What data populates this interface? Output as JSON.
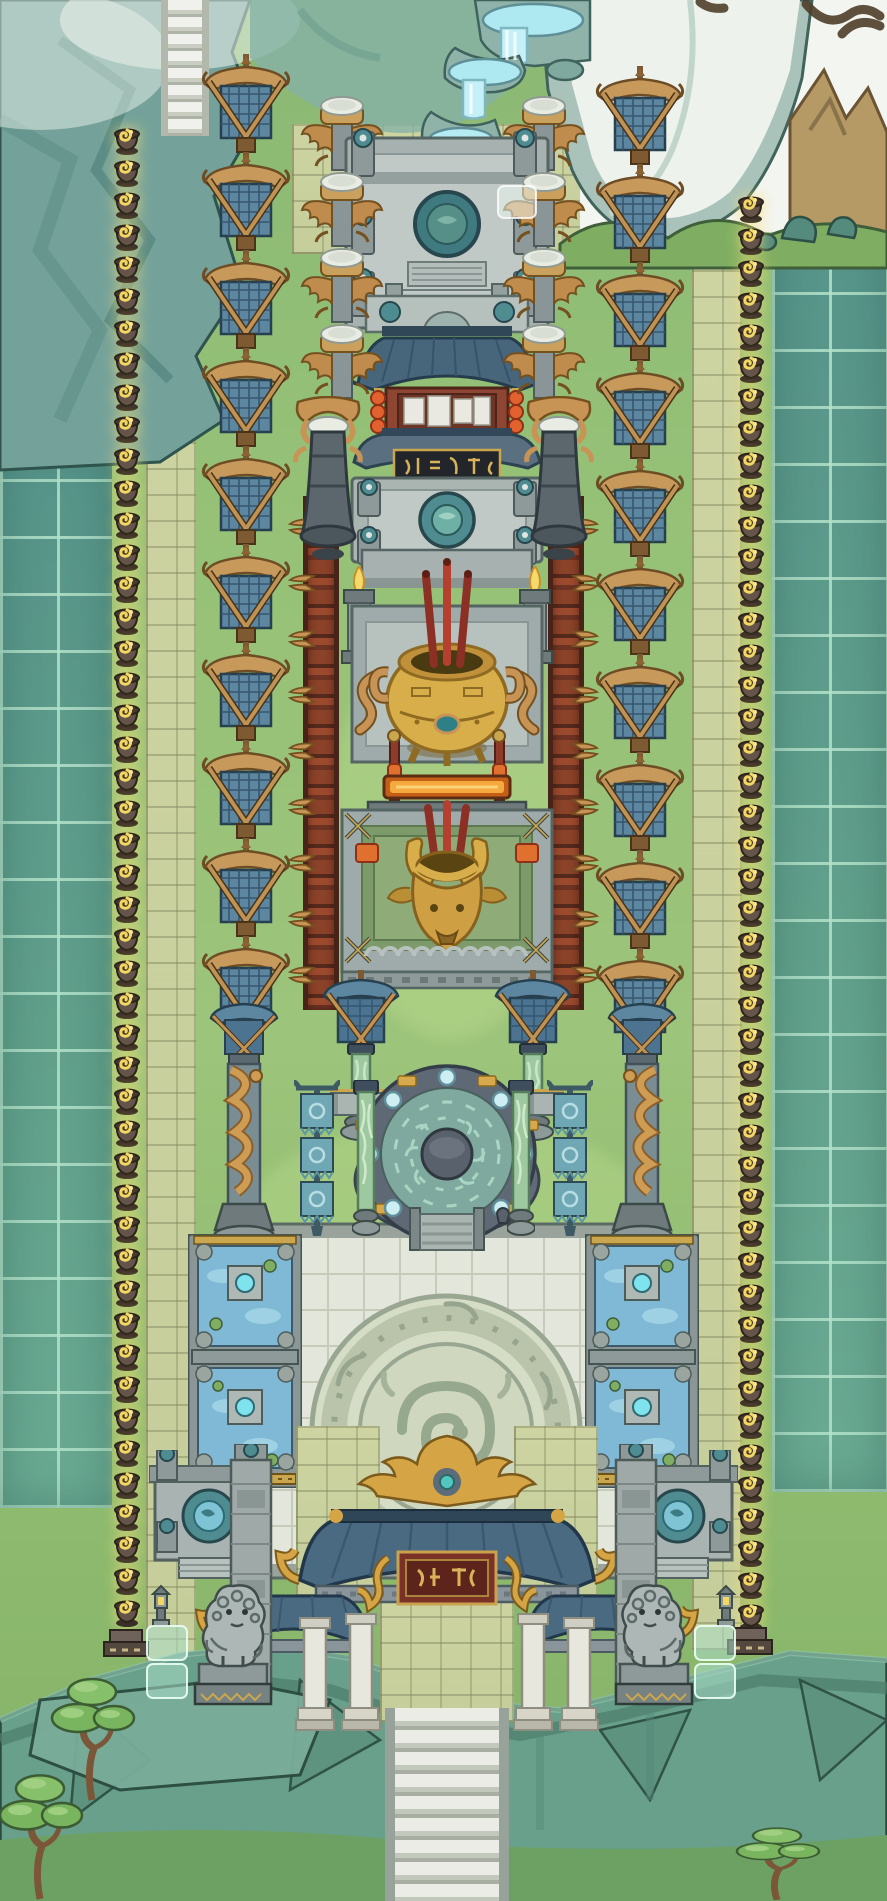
{
  "scene": {
    "name": "mountain-temple-courtyard-map",
    "description": "Top-down hand-painted game map of a long Chinese temple courtyard on a cliff plateau: waterfall and misty peaks at top, twin rows of banners, totem pillars and fire braziers descending to a gate with stone lions and cliff stairs at bottom.",
    "palette": {
      "grass": "#95c177",
      "grass_dark": "#84b268",
      "tile_teal": "#5f9c8b",
      "tile_glow": "#b2e2ca",
      "path_stone": "#cdd4a2",
      "mountain_teal": "#74a29a",
      "mist_white": "#f4f6f1",
      "peak_brown": "#b59a66",
      "banner_blue": "#5d86a0",
      "wood_gold": "#c79a5c",
      "stone_grey": "#9fabaa",
      "teal_cap": "#4e8c92",
      "gold": "#d8ae4a",
      "red_lacquer": "#8e4632",
      "incense_red": "#b5402f",
      "flame_yellow": "#f3d763",
      "roof_blue": "#4a6a82",
      "jade_green": "#9ec9a0",
      "plaza_white": "#e3e6da",
      "cliff_teal": "#68a08b",
      "pine_green": "#79b45f",
      "ember_orange": "#e07030",
      "rune_teal": "#7fa99f"
    },
    "landmarks": [
      {
        "label": "upper mountain stairway"
      },
      {
        "label": "waterfall terraces"
      },
      {
        "label": "upper stone altar with teal-capped pillars"
      },
      {
        "label": "notice pavilion with red lanterns"
      },
      {
        "label": "plaque hall with black tablet"
      },
      {
        "label": "secondary altar with teal disc"
      },
      {
        "label": "golden incense ding with three incense sticks"
      },
      {
        "label": "golden ox-head burner"
      },
      {
        "label": "banner gate with jade pillars"
      },
      {
        "label": "rune circle platform with glowing orbs"
      },
      {
        "label": "white plaza with carved dragon emblem"
      },
      {
        "label": "temple gate with phoenix crest and red plaque"
      },
      {
        "label": "bottom cliff stairway"
      }
    ],
    "decor_columns": [
      {
        "name": "brazier-column-left",
        "symbol": "brazier",
        "x": 111,
        "y": 124,
        "count": 47,
        "dy": 32,
        "w": 32,
        "h": 32,
        "act": false
      },
      {
        "name": "brazier-column-right",
        "symbol": "brazier",
        "x": 735,
        "y": 192,
        "count": 45,
        "dy": 32,
        "w": 32,
        "h": 32,
        "act": false
      },
      {
        "name": "banner-column-left",
        "symbol": "banner",
        "x": 199,
        "y": 54,
        "count": 10,
        "dy": 98,
        "w": 94,
        "h": 102,
        "act": false
      },
      {
        "name": "banner-column-right",
        "symbol": "banner",
        "x": 593,
        "y": 66,
        "count": 10,
        "dy": 98,
        "w": 94,
        "h": 102,
        "act": false
      },
      {
        "name": "totem-column-left",
        "symbol": "totem",
        "x": 298,
        "y": 94,
        "count": 4,
        "dy": 76,
        "w": 88,
        "h": 82,
        "act": false
      },
      {
        "name": "totem-column-right",
        "symbol": "totem",
        "x": 500,
        "y": 94,
        "count": 4,
        "dy": 76,
        "w": 88,
        "h": 82,
        "act": false
      },
      {
        "name": "fence-horns-left",
        "symbol": "horns",
        "x": 288,
        "y": 516,
        "count": 9,
        "dy": 56,
        "w": 28,
        "h": 22,
        "act": false
      },
      {
        "name": "fence-horns-right",
        "symbol": "horns",
        "x": 571,
        "y": 516,
        "count": 9,
        "dy": 56,
        "w": 28,
        "h": 22,
        "flip": true,
        "act": false
      }
    ],
    "objects": [
      {
        "name": "hanging-bell-left",
        "symbol": "bell",
        "x": 290,
        "y": 396,
        "w": 76,
        "h": 172,
        "z": 9,
        "act": false
      },
      {
        "name": "hanging-bell-right",
        "symbol": "bell",
        "x": 521,
        "y": 396,
        "w": 76,
        "h": 172,
        "z": 9,
        "flip": true,
        "act": false
      },
      {
        "name": "banner-gate-unit-left",
        "symbol": "gateunit",
        "x": 320,
        "y": 970,
        "w": 82,
        "h": 175,
        "act": false
      },
      {
        "name": "banner-gate-unit-right",
        "symbol": "gateunit",
        "x": 492,
        "y": 970,
        "w": 82,
        "h": 175,
        "flip": true,
        "act": false
      },
      {
        "name": "dragon-column-left",
        "symbol": "dragoncol",
        "x": 201,
        "y": 996,
        "w": 86,
        "h": 252,
        "act": true
      },
      {
        "name": "dragon-column-right",
        "symbol": "dragoncol",
        "x": 599,
        "y": 996,
        "w": 86,
        "h": 252,
        "flip": true,
        "act": true
      },
      {
        "name": "flag-stand-left",
        "symbol": "flagstand",
        "x": 294,
        "y": 1080,
        "w": 46,
        "h": 160,
        "act": false
      },
      {
        "name": "flag-stand-right",
        "symbol": "flagstand",
        "x": 547,
        "y": 1080,
        "w": 46,
        "h": 160,
        "act": false
      },
      {
        "name": "jade-column-left",
        "symbol": "jadecol",
        "x": 352,
        "y": 1080,
        "w": 28,
        "h": 162,
        "z": 15,
        "act": false
      },
      {
        "name": "jade-column-right",
        "symbol": "jadecol",
        "x": 507,
        "y": 1080,
        "w": 28,
        "h": 162,
        "z": 15,
        "act": false
      },
      {
        "name": "lotus-pool-left",
        "symbol": "pool",
        "x": 188,
        "y": 1234,
        "w": 114,
        "h": 254,
        "act": false
      },
      {
        "name": "lotus-pool-right",
        "symbol": "pool",
        "x": 585,
        "y": 1234,
        "w": 114,
        "h": 254,
        "act": false
      },
      {
        "name": "fountain-altar-left",
        "symbol": "fountain",
        "x": 149,
        "y": 1450,
        "w": 120,
        "h": 132,
        "act": true
      },
      {
        "name": "fountain-altar-right",
        "symbol": "fountain",
        "x": 618,
        "y": 1450,
        "w": 120,
        "h": 132,
        "act": true
      },
      {
        "name": "carved-wall-left",
        "symbol": "sidewall",
        "x": 227,
        "y": 1444,
        "w": 48,
        "h": 260,
        "act": false
      },
      {
        "name": "carved-wall-right",
        "symbol": "sidewall",
        "x": 612,
        "y": 1444,
        "w": 48,
        "h": 260,
        "act": false
      },
      {
        "name": "stone-lion-left",
        "symbol": "lion",
        "x": 193,
        "y": 1568,
        "w": 80,
        "h": 140,
        "z": 19,
        "act": true
      },
      {
        "name": "stone-lion-right",
        "symbol": "lion",
        "x": 614,
        "y": 1568,
        "w": 80,
        "h": 140,
        "z": 19,
        "flip": true,
        "act": true
      },
      {
        "name": "stone-lantern-left",
        "symbol": "lantern",
        "x": 149,
        "y": 1584,
        "w": 24,
        "h": 44,
        "z": 19,
        "act": false
      },
      {
        "name": "stone-lantern-right",
        "symbol": "lantern",
        "x": 714,
        "y": 1584,
        "w": 24,
        "h": 44,
        "z": 19,
        "act": false
      },
      {
        "name": "brazier-base-left",
        "symbol": "brazierbase",
        "x": 102,
        "y": 1628,
        "w": 48,
        "h": 32,
        "z": 20,
        "act": false
      },
      {
        "name": "brazier-base-right",
        "symbol": "brazierbase",
        "x": 726,
        "y": 1626,
        "w": 48,
        "h": 32,
        "z": 20,
        "act": false
      },
      {
        "name": "ghost-tile",
        "symbol": "ghosttile",
        "x": 496,
        "y": 184,
        "w": 42,
        "h": 36,
        "act": false
      },
      {
        "name": "glass-tiles-left",
        "symbol": "glasstile",
        "x": 145,
        "y": 1624,
        "w": 44,
        "h": 76,
        "z": 20,
        "act": false
      },
      {
        "name": "glass-tiles-right",
        "symbol": "glasstile",
        "x": 693,
        "y": 1624,
        "w": 44,
        "h": 76,
        "z": 20,
        "act": false
      },
      {
        "name": "pine-tree-1",
        "symbol": "pine",
        "x": 40,
        "y": 1662,
        "w": 105,
        "h": 140,
        "z": 20,
        "act": false
      },
      {
        "name": "pine-tree-2",
        "symbol": "pine",
        "x": -12,
        "y": 1758,
        "w": 105,
        "h": 143,
        "z": 21,
        "act": false
      },
      {
        "name": "pine-tree-3",
        "symbol": "pine",
        "x": 725,
        "y": 1818,
        "w": 105,
        "h": 83,
        "z": 22,
        "act": false
      }
    ]
  }
}
